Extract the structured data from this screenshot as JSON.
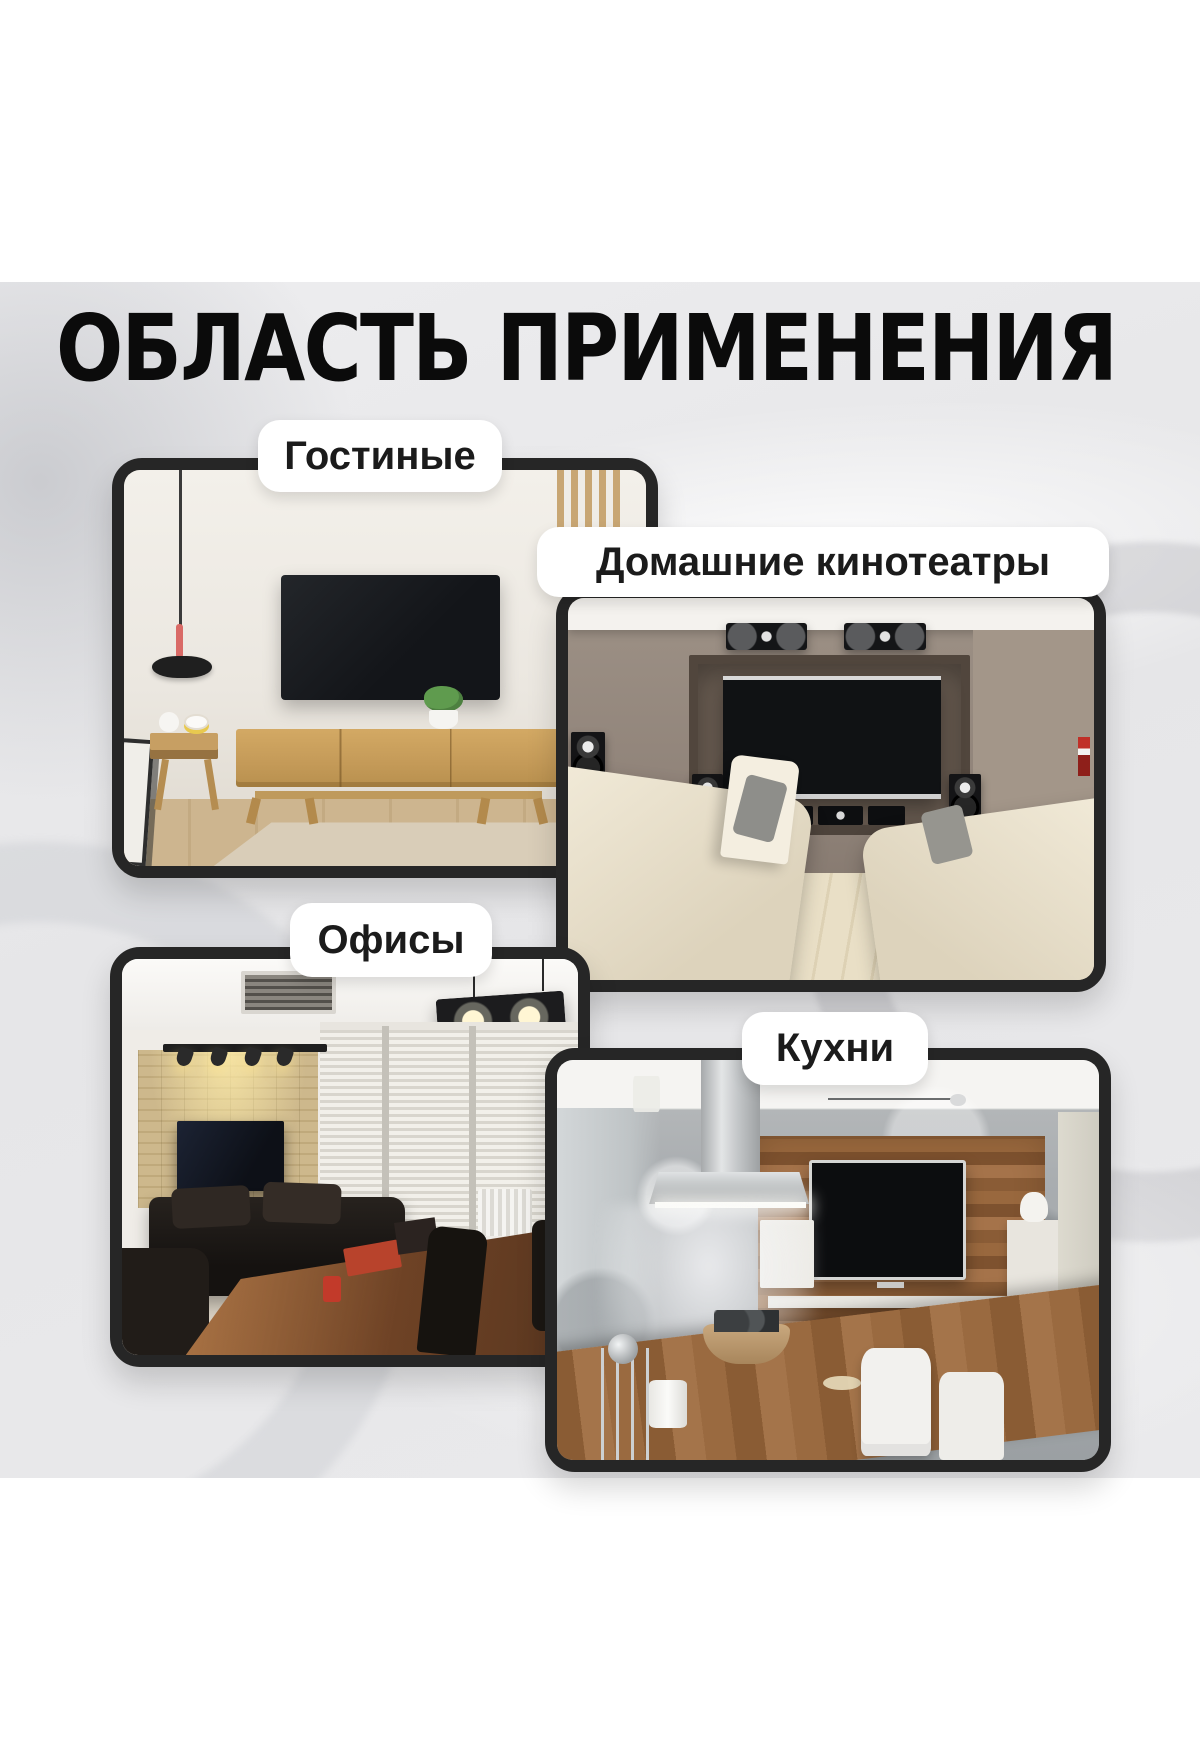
{
  "page": {
    "title": "ОБЛАСТЬ ПРИМЕНЕНИЯ"
  },
  "cards": [
    {
      "id": "living-rooms",
      "label": "Гостиные",
      "photo_description": "Living room with a wall-mounted TV above a wooden media console, pendant lamp, side table and rug"
    },
    {
      "id": "home-theaters",
      "label": "Домашние кинотеатры",
      "photo_description": "Home theater with a large screen in a recessed taupe wall niche, speakers and two cream lounge sofas"
    },
    {
      "id": "offices",
      "label": "Офисы",
      "photo_description": "Office lounge with a TV on a stone accent wall, track lights, window blinds, leather sofa and a wooden conference table"
    },
    {
      "id": "kitchens",
      "label": "Кухни",
      "photo_description": "Kitchen with a TV on a wooden accent wall, stainless range hood, white cabinets and a wooden bar counter with stools"
    }
  ],
  "colors": {
    "page_background": "#ffffff",
    "band_background": "#e9e9eb",
    "frame_border": "#262626",
    "label_background": "#ffffff",
    "label_text": "#1b1b1b",
    "title_text": "#0b0b0b"
  }
}
